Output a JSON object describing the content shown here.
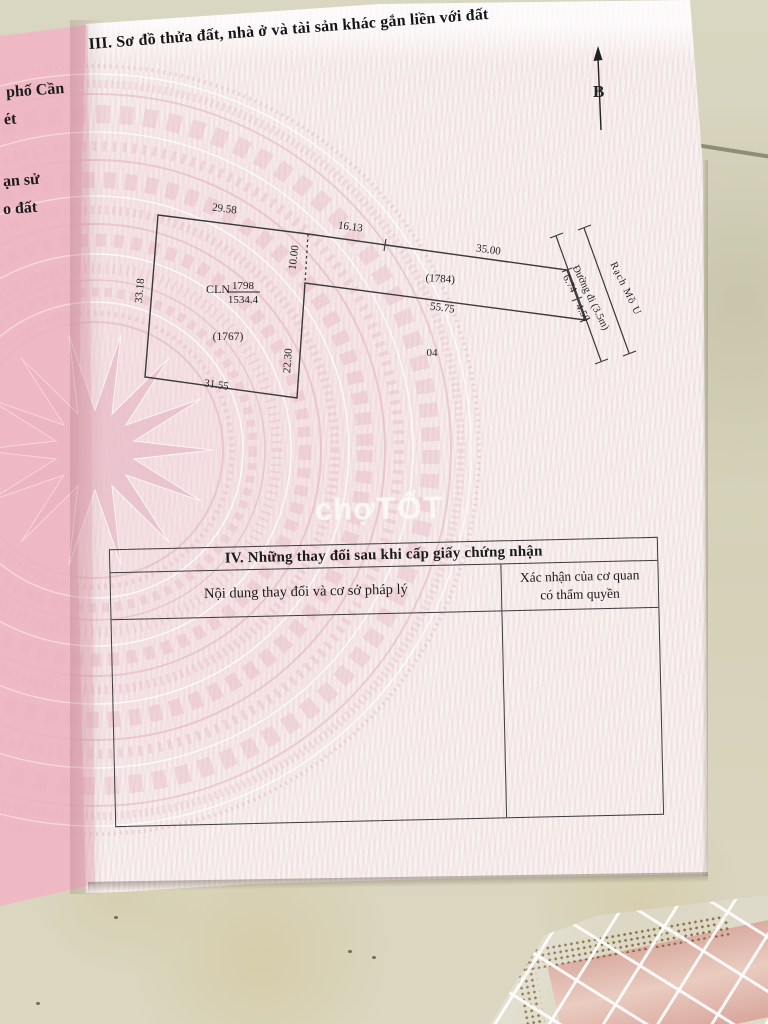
{
  "document": {
    "section_iii_title": "III. Sơ đồ thửa đất, nhà ở và tài sản khác gắn liền với đất",
    "north_arrow_label": "B",
    "left_page_fragments": {
      "line1": "phố Cần",
      "line2": "ét",
      "line3": "ạn sử",
      "line4": "o đất"
    },
    "watermark_part1": "chợ",
    "watermark_part2": "TỐT"
  },
  "diagram": {
    "parcel_land_use": "CLN",
    "parcel_number": "1798",
    "parcel_area": "1534.4",
    "neighbor_parcel_left": "(1767)",
    "neighbor_parcel_right": "(1784)",
    "zone_label": "04",
    "road_label": "Đường đi (3.5m)",
    "canal_label": "Rạch Mồ U",
    "dim_top": "29.58",
    "dim_top2": "16.13",
    "dim_top3": "35.00",
    "dim_dashed": "10.00",
    "dim_left": "33.18",
    "dim_inner_right": "22.30",
    "dim_bottom": "31.55",
    "dim_strip_bottom": "55.75",
    "dim_frontage1": "6.74",
    "dim_frontage2": "4.50"
  },
  "section_iv": {
    "title": "IV. Những thay đổi sau khi cấp giấy chứng nhận",
    "col1_header": "Nội dung thay đổi và cơ sở pháp lý",
    "col2_header_line1": "Xác nhận của cơ quan",
    "col2_header_line2": "có thẩm quyền"
  },
  "colors": {
    "floor": "#d7d3bd",
    "page": "#f7f1ef",
    "left_page_pink": "#eec2cb",
    "pattern_pink": "#e6bac5",
    "ink": "#1d1d1d",
    "watermark_white": "#faf8f4"
  }
}
